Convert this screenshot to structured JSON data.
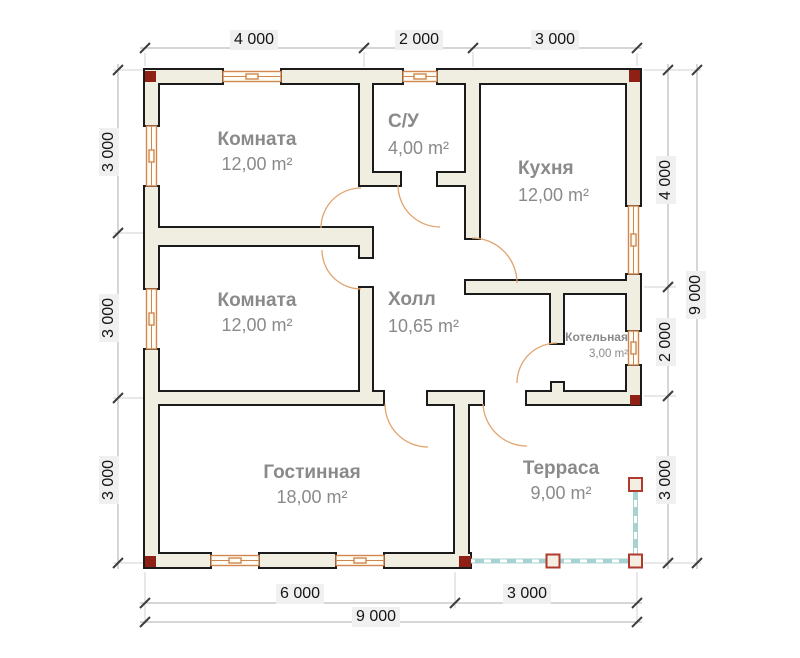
{
  "plan": {
    "rooms": {
      "bedroom1": {
        "name": "Комната",
        "area": "12,00 m²"
      },
      "bathroom": {
        "name": "С/У",
        "area": "4,00 m²"
      },
      "kitchen": {
        "name": "Кухня",
        "area": "12,00 m²"
      },
      "bedroom2": {
        "name": "Комната",
        "area": "12,00 m²"
      },
      "hall": {
        "name": "Холл",
        "area": "10,65 m²"
      },
      "boiler": {
        "name": "Котельная",
        "area": "3,00 m²"
      },
      "living": {
        "name": "Гостинная",
        "area": "18,00 m²"
      },
      "terrace": {
        "name": "Терраса",
        "area": "9,00 m²"
      }
    },
    "dimensions": {
      "top": [
        "4 000",
        "2 000",
        "3 000"
      ],
      "left": [
        "3 000",
        "3 000",
        "3 000"
      ],
      "right": [
        "4 000",
        "2 000",
        "3 000"
      ],
      "right_total": "9 000",
      "bottom": [
        "6 000",
        "3 000"
      ],
      "bottom_total": "9 000"
    },
    "colors": {
      "wall_fill": "#f0eee1",
      "wall_stroke": "#1b1b1b",
      "window": "#d0874f",
      "door_arc": "#e2a36e",
      "terrace_rail": "#a6d3d1",
      "corner_mark": "#8e2015",
      "post_border": "#b03a2e",
      "dim_text_bg": "#f0f0f0",
      "room_label": "#8a8a8a"
    }
  }
}
